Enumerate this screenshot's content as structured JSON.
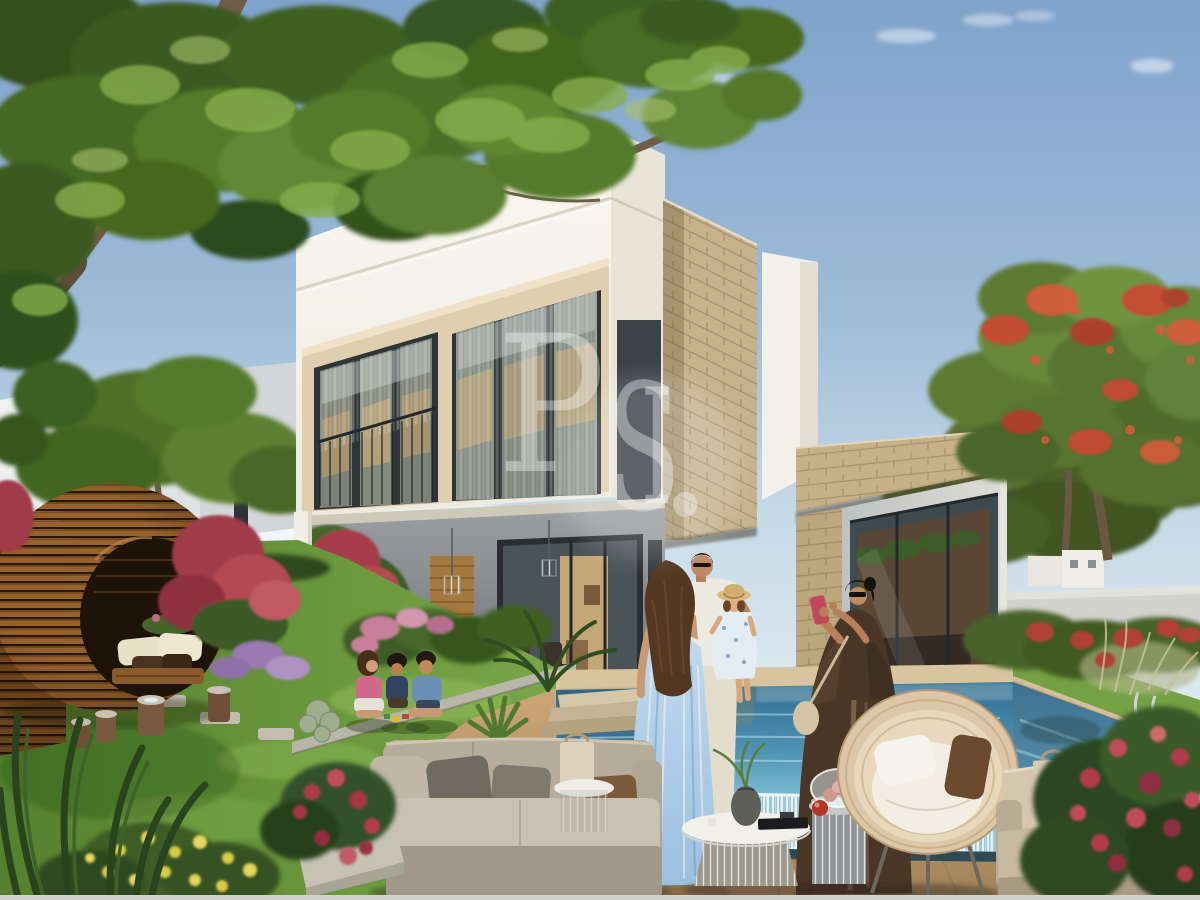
{
  "image": {
    "kind": "photorealistic real-estate rendering",
    "description": "Sunlit modern two-storey villa with cream stone accents, covered patio, infinity-edge pool with waterfall, lawned garden, egg-shaped timber pavilion, outdoor lounge furniture and a family being photographed beside the pool",
    "watermark": {
      "text": "PSI.",
      "letters": {
        "p": "P",
        "s": "S",
        "i": "I",
        "dot": "."
      },
      "color": "#ffffff",
      "opacity": 0.36
    }
  },
  "palette": {
    "sky_top": "#7fa3cc",
    "sky_horizon": "#dde9f0",
    "villa_white": "#f6f4ee",
    "accent_band": "#e0cfae",
    "stone_cladding": "#c6b28c",
    "window_frame": "#2e3437",
    "pool_deep": "#316e90",
    "pool_light": "#7fc0d4",
    "deck_tan": "#c19a6d",
    "lawn_green": "#6d9a3e",
    "pavilion_wood": "#95622c",
    "sofa_taupe": "#b9af9f",
    "abaya_brown": "#4a3626",
    "dress_blue": "#aac9e4",
    "flower_red": "#b8404e"
  }
}
